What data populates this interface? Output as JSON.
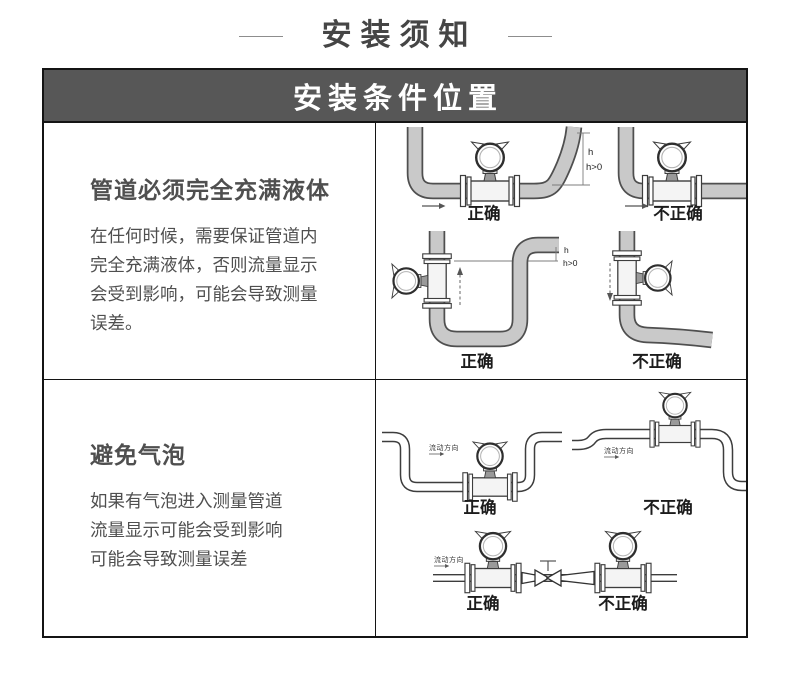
{
  "page": {
    "title": "安装须知"
  },
  "panel": {
    "header": "安装条件位置"
  },
  "sections": [
    {
      "heading": "管道必须完全充满液体",
      "body_lines": [
        "在任何时候，需要保证管道内",
        "完全充满液体，否则流量显示",
        "会受到影响，可能会导致测量",
        "误差。"
      ]
    },
    {
      "heading": "避免气泡",
      "body_lines": [
        "如果有气泡进入测量管道",
        "流量显示可能会受到影响",
        "可能会导致测量误差"
      ]
    }
  ],
  "diagram_labels": {
    "correct": "正确",
    "incorrect": "不正确",
    "height": "h",
    "height_condition": "h>0",
    "flow_direction": "流动方向"
  },
  "colors": {
    "header_bg": "#575757",
    "header_text": "#ffffff",
    "border": "#141414",
    "heading_text": "#4f4f4f",
    "body_text": "#4f4f4f",
    "pipe_fill": "#c9c9c9",
    "diagram_line": "#3d3d3d"
  }
}
